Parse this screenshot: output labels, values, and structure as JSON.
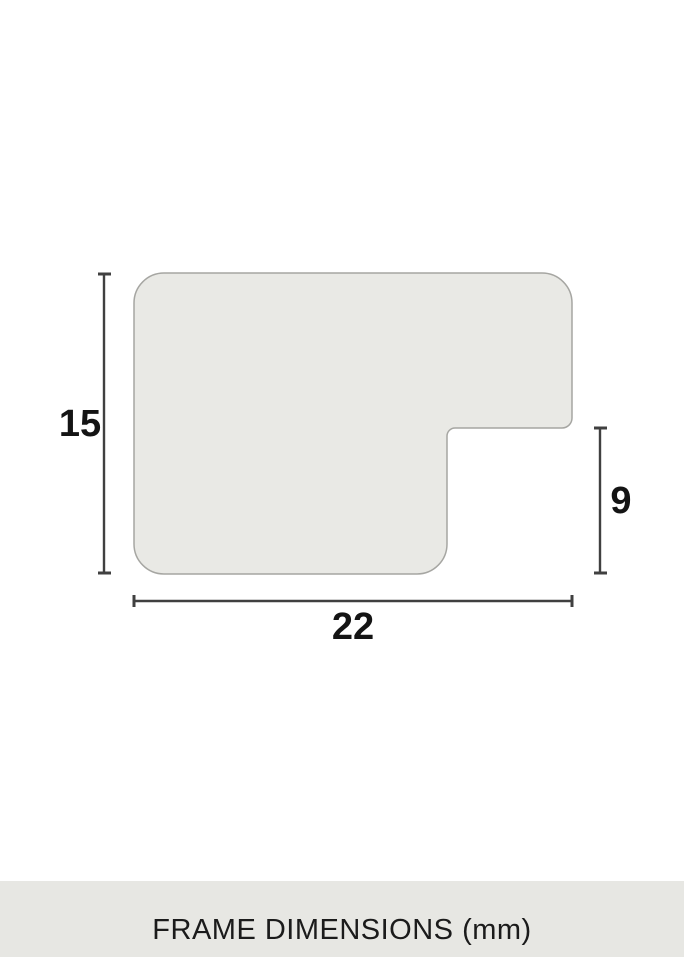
{
  "diagram": {
    "dimensions": {
      "height_mm": "15",
      "depth_mm": "9",
      "width_mm": "22"
    }
  },
  "footer": {
    "label": "FRAME DIMENSIONS (mm)"
  },
  "colors": {
    "background": "#ffffff",
    "shape_fill": "#e9e9e5",
    "shape_stroke": "#a6a6a2",
    "dimension_line": "#404040",
    "label_text": "#141414",
    "footer_band": "#e7e7e3",
    "footer_text": "#1b1b1b"
  }
}
